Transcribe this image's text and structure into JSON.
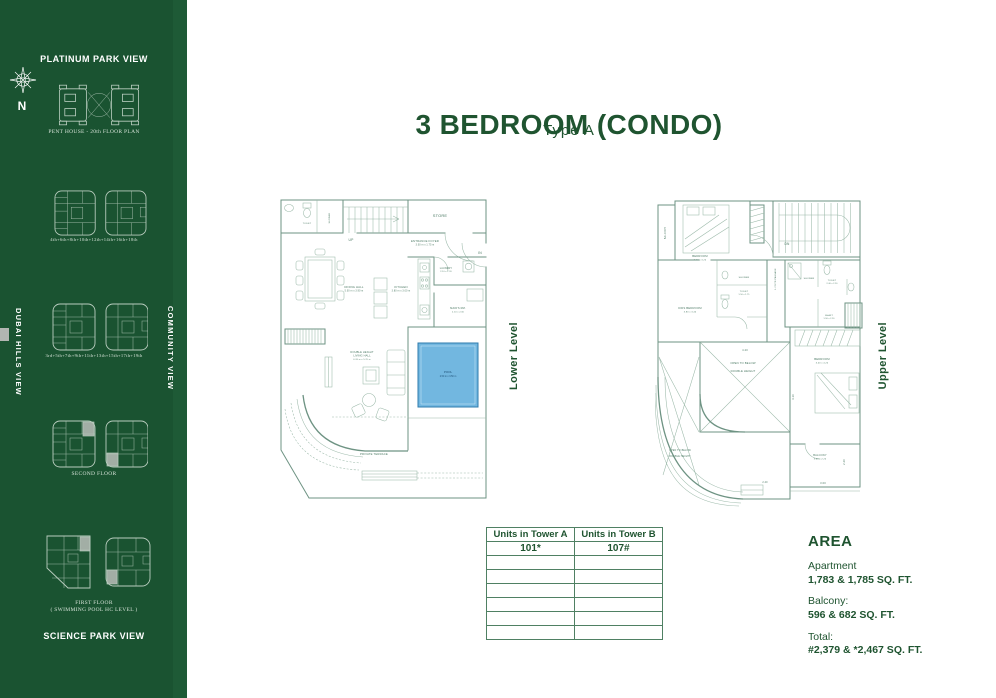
{
  "title": {
    "main": "3 BEDROOM (CONDO)",
    "sub": "Type A"
  },
  "colors": {
    "sidebar_green": "#1a5331",
    "accent_green": "#1f5430",
    "plan_line": "#6e9383",
    "pool_blue": "#72b7e0",
    "table_border": "#4f8063"
  },
  "sidebar": {
    "compass_n": "N",
    "heading_top": "PLATINUM PARK VIEW",
    "heading_bottom": "SCIENCE PARK VIEW",
    "vertical_left": "DUBAI HILLS VIEW",
    "vertical_right": "COMMUNITY VIEW",
    "captions": {
      "penthouse": "PENT HOUSE - 20th FLOOR PLAN",
      "even_floors": "4th+6th+8th+10th+12th+14th+16th+18th",
      "odd_floors": "3rd+5th+7th+9th+11th+13th+15th+17th+19th",
      "second_floor": "SECOND FLOOR",
      "first_floor_1": "FIRST FLOOR",
      "first_floor_2": "( SWIMMING POOL HC LEVEL )"
    }
  },
  "lower_level": {
    "label": "Lower Level",
    "rooms": {
      "toilet": "TOILET",
      "shower": "SHOWER",
      "up": "UP",
      "store": "STORE",
      "foyer1": "ENTRANCE FOYER",
      "foyer_dim": "3.00 m x 1.75 m",
      "in_label": "IN",
      "dining": "DINING HALL",
      "dining_dim": "5.00 m x 3.90 m",
      "kitchen": "KITCHEN",
      "kitchen_dim": "3.80 m x 3.00 m",
      "laundry": "LAUNDRY",
      "laundry_dim": "2.10 x 1.20",
      "maids": "MAID'S RM.",
      "maids_dim": "2.10 x 2.00",
      "living1": "DOUBLE HEIGHT",
      "living2": "LIVING HALL",
      "living_dim": "6.20 m x 5.70 m",
      "pool": "POOL",
      "pool_dim": "2.50 m x 3.50 m",
      "terrace": "PRIVATE TERRACE"
    }
  },
  "upper_level": {
    "label": "Upper Level",
    "rooms": {
      "balcony1": "BALCONY",
      "bedroom1": "BEDROOM",
      "bedroom1_dim": "3.40 x 3.20",
      "dn": "DN",
      "shower1": "SHOWER",
      "toilet1": "TOILET",
      "toilet1_dim": "1.50 x 1.75",
      "kids": "KIDS BEDROOM",
      "kids_dim": "3.80 x 3.40",
      "passage": "1.2 MTR PASSAGE",
      "shower2": "SHOWER",
      "toilet2": "TOILET",
      "toilet2_dim": "2.40 x 2.20",
      "shaft": "SHAFT",
      "shaft_dim": "1.90 x 2.20",
      "open1a": "OPEN TO BELOW",
      "open1b": "DOUBLE HEIGHT",
      "open2a": "OPEN TO BELOW",
      "open2b": "DOUBLE HEIGHT",
      "bedroom2": "BEDROOM",
      "bedroom2_dim": "3.40 x 4.20",
      "balcony2": "BALCONY",
      "balcony2_dim": "3.60 x 2.20",
      "dim_420": "4.20",
      "dim_410": "4.10",
      "dim_300": "3.00",
      "dim_220": "2.20",
      "dim_240": "2.40"
    }
  },
  "units_table": {
    "header_a": "Units in Tower A",
    "header_b": "Units in Tower B",
    "unit_a": "101*",
    "unit_b": "107#"
  },
  "area": {
    "heading": "AREA",
    "apartment_label": "Apartment",
    "apartment_value": "1,783 & 1,785 SQ. FT.",
    "balcony_label": "Balcony:",
    "balcony_value": "596 & 682 SQ. FT.",
    "total_label": "Total:",
    "total_value": "#2,379 & *2,467 SQ. FT."
  }
}
